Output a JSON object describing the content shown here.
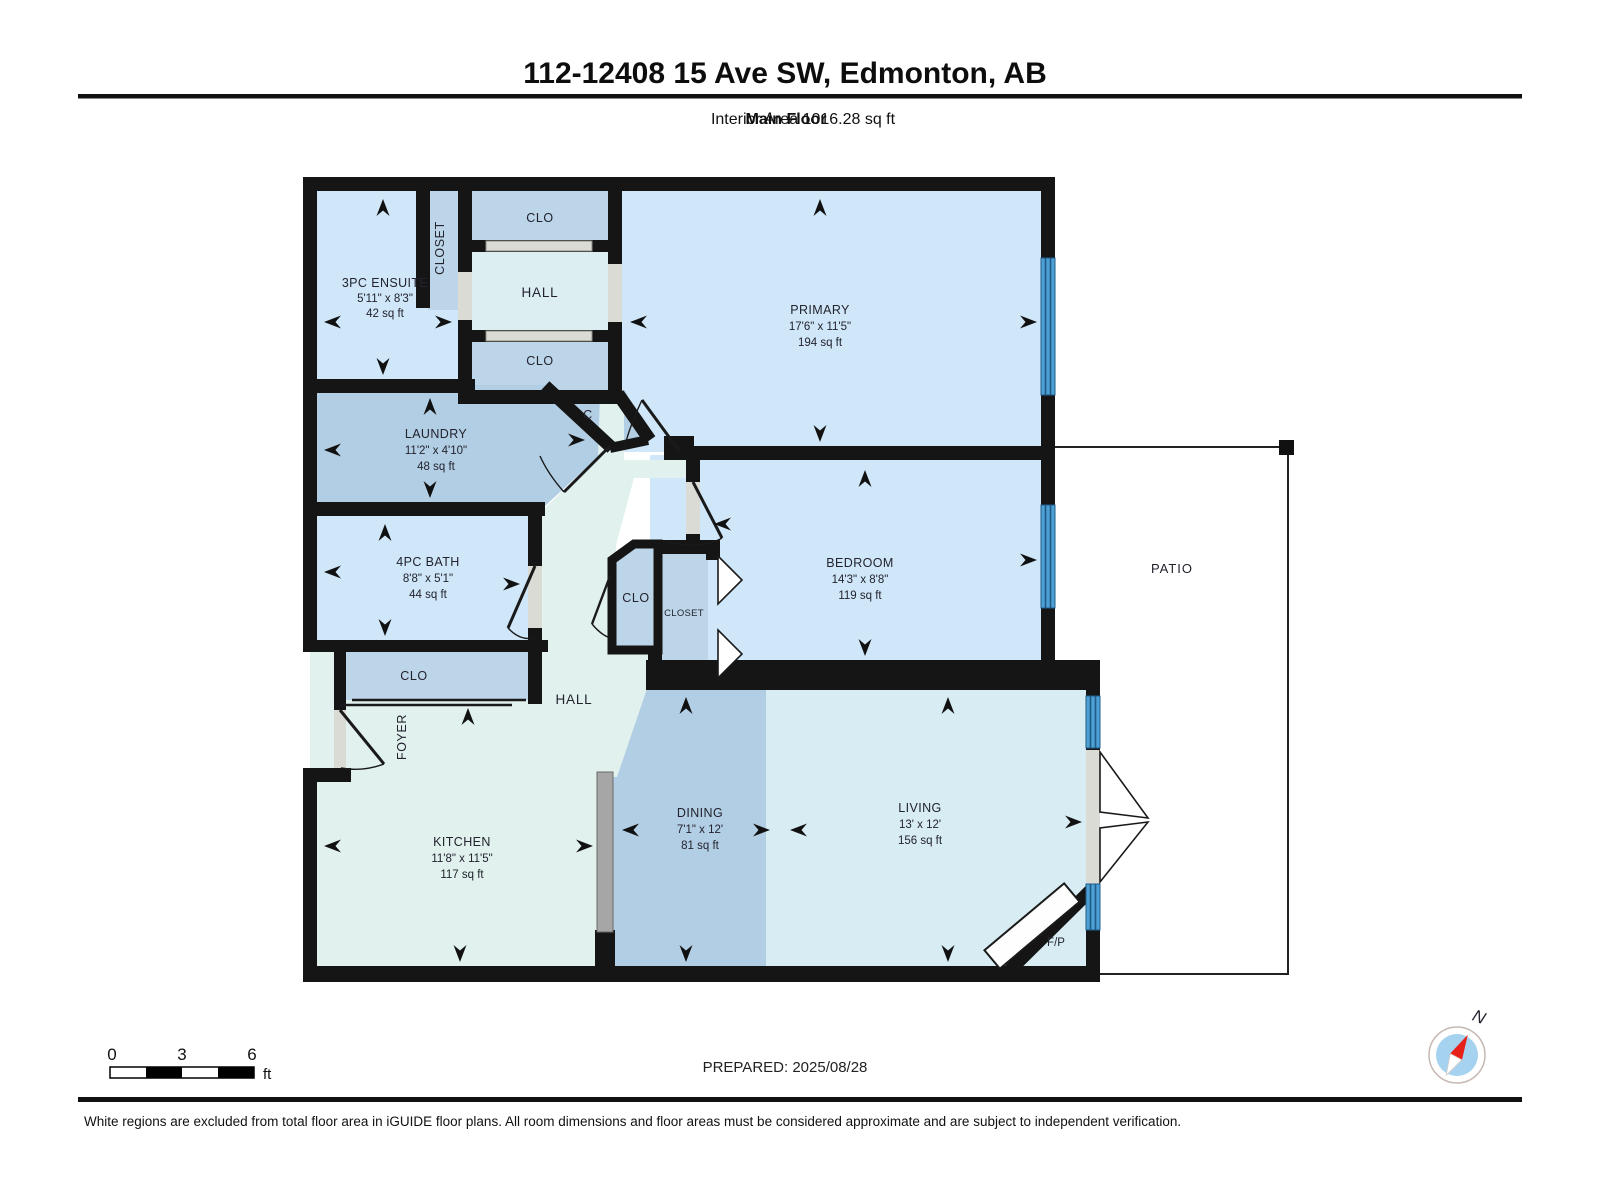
{
  "header": {
    "title": "112-12408 15 Ave SW, Edmonton, AB",
    "floor_label": "Main Floor",
    "area_label": "Interior Area 1016.28 sq ft"
  },
  "rooms": {
    "ensuite": {
      "name": "3PC ENSUITE",
      "dims": "5'11\" x 8'3\"",
      "area": "42 sq ft"
    },
    "ensuite_closet": {
      "name": "CLOSET"
    },
    "clo_upper": {
      "name": "CLO"
    },
    "hall_upper": {
      "name": "HALL"
    },
    "clo_lower": {
      "name": "CLO"
    },
    "primary": {
      "name": "PRIMARY",
      "dims": "17'6\" x 11'5\"",
      "area": "194 sq ft"
    },
    "laundry": {
      "name": "LAUNDRY",
      "dims": "11'2\" x 4'10\"",
      "area": "48 sq ft"
    },
    "c_closet": {
      "name": "C"
    },
    "bath": {
      "name": "4PC BATH",
      "dims": "8'8\" x 5'1\"",
      "area": "44 sq ft"
    },
    "bedroom": {
      "name": "BEDROOM",
      "dims": "14'3\" x 8'8\"",
      "area": "119 sq ft"
    },
    "clo_mid": {
      "name": "CLO"
    },
    "bedroom_closet": {
      "name": "CLOSET"
    },
    "patio": {
      "name": "PATIO"
    },
    "foyer_clo": {
      "name": "CLO"
    },
    "foyer": {
      "name": "FOYER"
    },
    "hall_main": {
      "name": "HALL"
    },
    "kitchen": {
      "name": "KITCHEN",
      "dims": "11'8\" x 11'5\"",
      "area": "117 sq ft"
    },
    "dining": {
      "name": "DINING",
      "dims": "7'1\" x 12'",
      "area": "81 sq ft"
    },
    "living": {
      "name": "LIVING",
      "dims": "13' x 12'",
      "area": "156 sq ft"
    },
    "fireplace": {
      "name": "F/P"
    }
  },
  "scale_bar": {
    "tick0": "0",
    "tick3": "3",
    "tick6": "6",
    "unit": "ft"
  },
  "compass": {
    "north_label": "N"
  },
  "footer": {
    "prepared": "PREPARED: 2025/08/28",
    "disclaimer": "White regions are excluded from total floor area in iGUIDE floor plans. All room dimensions and floor areas must be considered approximate and are subject to independent verification."
  },
  "colors": {
    "wall": "#151515",
    "room_light_blue": "#cfe7f8",
    "room_medium_blue": "#b2cee4",
    "room_pale_mint": "#e0f1ee",
    "room_living": "#d8ecf3",
    "window_blue": "#4d9fd4",
    "opening_grey": "#dbdbd5",
    "counter_grey": "#a6a6a6",
    "compass_red": "#e8201a",
    "compass_face": "#a5d2ee"
  }
}
